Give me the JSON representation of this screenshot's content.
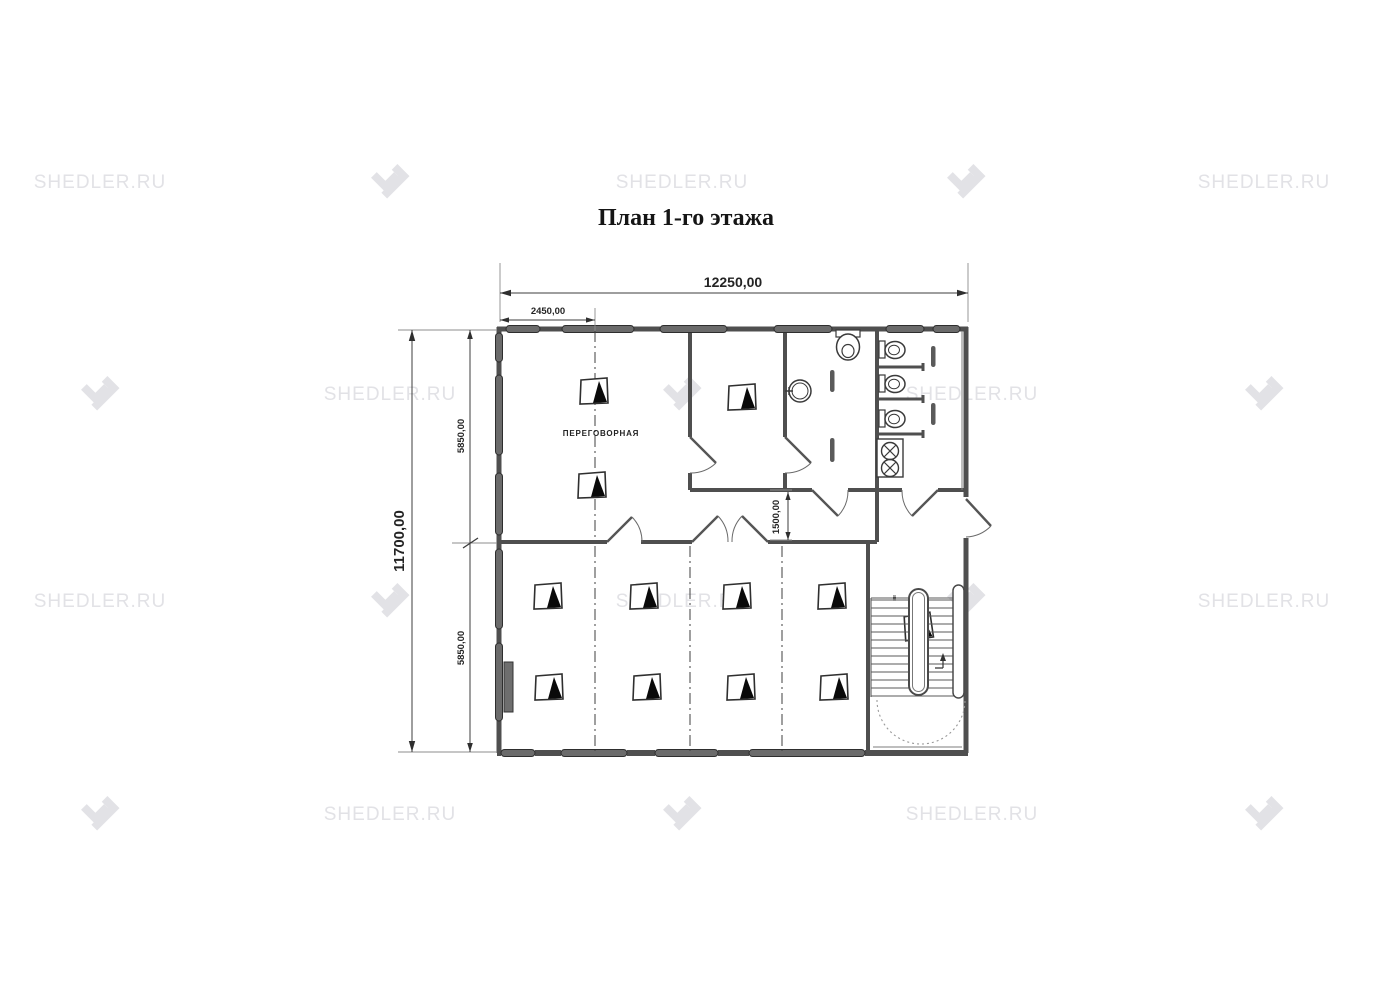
{
  "title": "План 1-го этажа",
  "watermark": {
    "text": "SHEDLER.RU",
    "color": "#e2e2e6",
    "cells": [
      {
        "x": 100,
        "y": 183,
        "type": "text"
      },
      {
        "x": 390,
        "y": 183,
        "type": "logo"
      },
      {
        "x": 682,
        "y": 183,
        "type": "text"
      },
      {
        "x": 966,
        "y": 183,
        "type": "logo"
      },
      {
        "x": 1264,
        "y": 183,
        "type": "text"
      },
      {
        "x": 100,
        "y": 395,
        "type": "logo"
      },
      {
        "x": 390,
        "y": 395,
        "type": "text"
      },
      {
        "x": 682,
        "y": 395,
        "type": "logo"
      },
      {
        "x": 972,
        "y": 395,
        "type": "text"
      },
      {
        "x": 1264,
        "y": 395,
        "type": "logo"
      },
      {
        "x": 100,
        "y": 602,
        "type": "text"
      },
      {
        "x": 390,
        "y": 602,
        "type": "logo"
      },
      {
        "x": 682,
        "y": 602,
        "type": "text"
      },
      {
        "x": 966,
        "y": 602,
        "type": "logo"
      },
      {
        "x": 1264,
        "y": 602,
        "type": "text"
      },
      {
        "x": 100,
        "y": 815,
        "type": "logo"
      },
      {
        "x": 390,
        "y": 815,
        "type": "text"
      },
      {
        "x": 682,
        "y": 815,
        "type": "logo"
      },
      {
        "x": 972,
        "y": 815,
        "type": "text"
      },
      {
        "x": 1264,
        "y": 815,
        "type": "logo"
      }
    ]
  },
  "plan": {
    "room_label": "ПЕРЕГОВОРНАЯ",
    "stairs_label": "вв",
    "dimensions": {
      "total_width": "12250,00",
      "sub_width": "2450,00",
      "total_height": "11700,00",
      "upper_height": "5850,00",
      "lower_height": "5850,00",
      "corridor_height": "1500,00"
    },
    "colors": {
      "wall": "#4f4f4f",
      "window": "#6b6b6b",
      "dimension": "#3c3c3c",
      "watermark": "#e2e2e6"
    }
  }
}
